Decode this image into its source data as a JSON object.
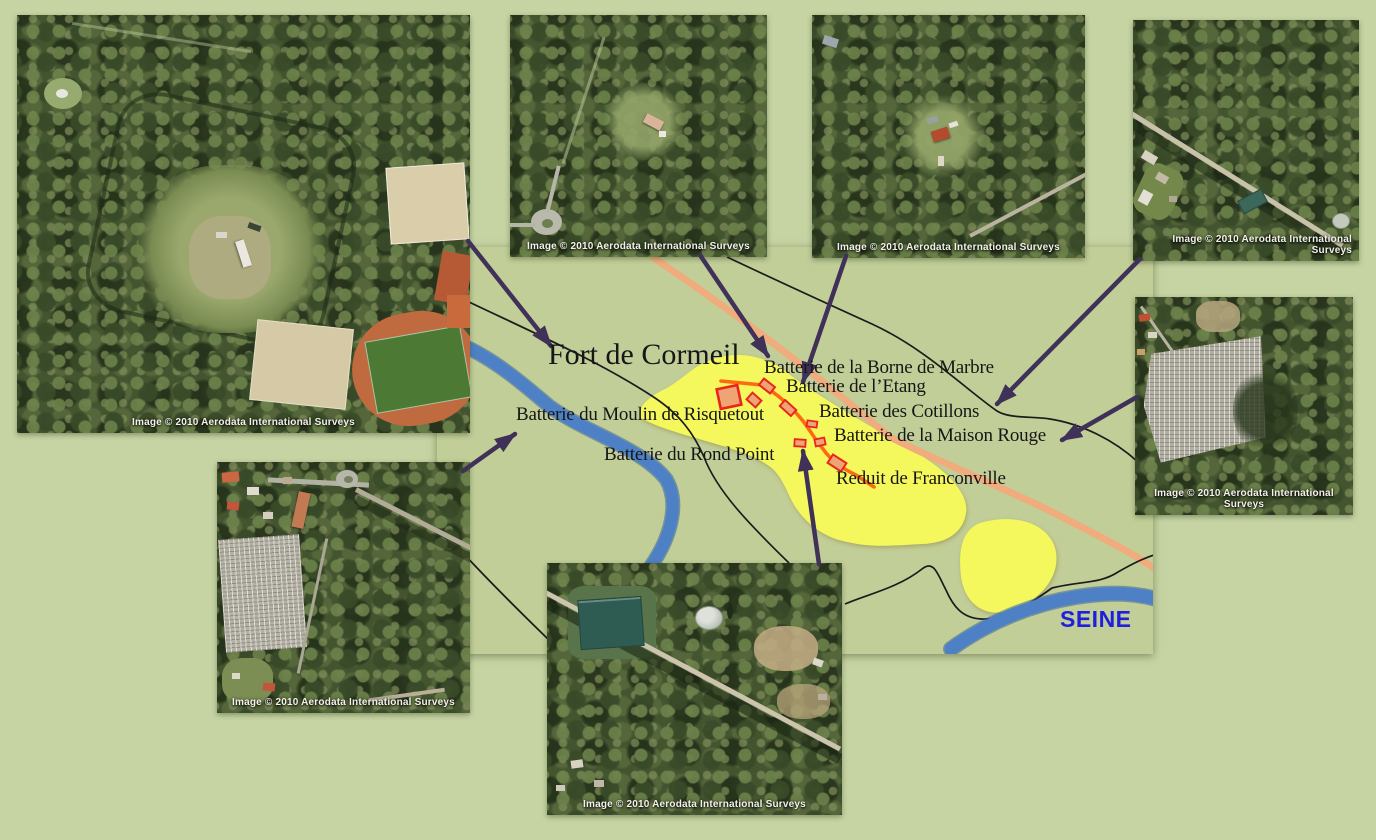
{
  "map": {
    "fort_label": "Fort de Cormeil",
    "river_label": "SEINE",
    "labels": [
      {
        "text": "Batterie de la Borne de Marbre"
      },
      {
        "text": "Batterie de l’Etang"
      },
      {
        "text": "Batterie des Cotillons"
      },
      {
        "text": "Batterie de la Maison Rouge"
      },
      {
        "text": "Batterie du Moulin de Risquetout"
      },
      {
        "text": "Batterie du Rond Point"
      },
      {
        "text": "Reduit de Franconville"
      }
    ],
    "colors": {
      "page_green": "#c6d4a3",
      "map_green": "#c1ce98",
      "zone_yellow": "#f5f85c",
      "main_road_orange": "#f0ac7c",
      "battery_path_orange": "#fd6a12",
      "river_blue": "#4d80c4",
      "arrow_purple": "#3f3157",
      "battery_marker_red": "#e8261d",
      "river_label_blue": "#1f1fdd"
    }
  },
  "images": [
    {
      "name": "fort-de-cormeil",
      "caption": "Image © 2010 Aerodata International Surveys"
    },
    {
      "name": "borne-de-marbre",
      "caption": "Image © 2010 Aerodata International Surveys"
    },
    {
      "name": "etang",
      "caption": "Image © 2010 Aerodata International Surveys"
    },
    {
      "name": "cotillons",
      "caption": "Image ©  2010 Aerodata International Surveys"
    },
    {
      "name": "maison-rouge",
      "caption": "Image © 2010 Aerodata International Surveys"
    },
    {
      "name": "moulin-de-risquetout",
      "caption": "Image © 2010 Aerodata International Surveys"
    },
    {
      "name": "rond-point",
      "caption": "Image © 2010 Aerodata International Surveys"
    }
  ]
}
